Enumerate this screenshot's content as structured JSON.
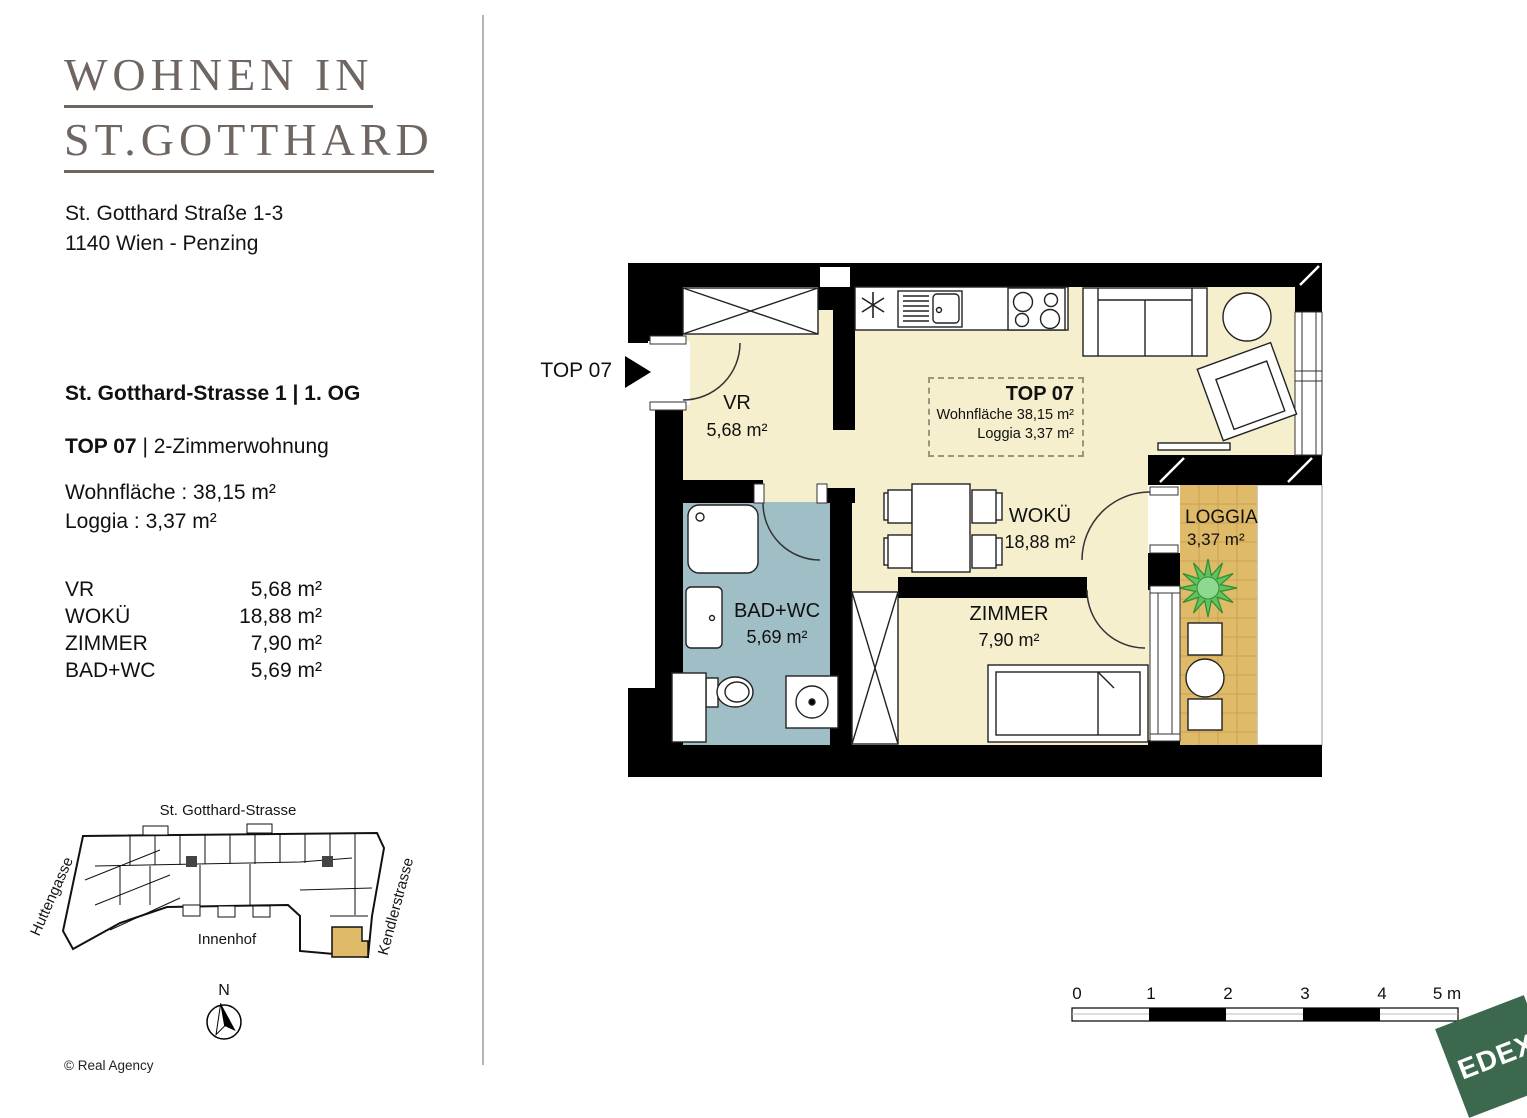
{
  "branding": {
    "title_line1": "WOHNEN IN",
    "title_line2": "ST.GOTTHARD",
    "address_line1": "St. Gotthard Straße 1-3",
    "address_line2": "1140 Wien - Penzing"
  },
  "unit_info": {
    "location": "St. Gotthard-Strasse 1 | 1. OG",
    "unit_name": "TOP 07",
    "unit_type": "| 2-Zimmerwohnung",
    "living_area": "Wohnfläche : 38,15 m²",
    "loggia_area": "Loggia : 3,37 m²"
  },
  "room_table": [
    {
      "name": "VR",
      "area": "5,68 m²"
    },
    {
      "name": "WOKÜ",
      "area": "18,88 m²"
    },
    {
      "name": "ZIMMER",
      "area": "7,90 m²"
    },
    {
      "name": "BAD+WC",
      "area": "5,69 m²"
    }
  ],
  "floor_plan": {
    "entry_label": "TOP 07",
    "info_box": {
      "title": "TOP 07",
      "living": "Wohnfläche 38,15 m²",
      "loggia": "Loggia 3,37 m²"
    },
    "rooms": {
      "vr": {
        "name": "VR",
        "area": "5,68 m²"
      },
      "woku": {
        "name": "WOKÜ",
        "area": "18,88 m²"
      },
      "zimmer": {
        "name": "ZIMMER",
        "area": "7,90 m²"
      },
      "bad": {
        "name": "BAD+WC",
        "area": "5,69 m²"
      },
      "loggia": {
        "name": "LOGGIA",
        "area": "3,37 m²"
      }
    }
  },
  "site_plan": {
    "street_top": "St. Gotthard-Strasse",
    "street_left": "Huttengasse",
    "street_right": "Kendlerstrasse",
    "courtyard": "Innenhof",
    "north": "N"
  },
  "scale_bar": {
    "labels": [
      "0",
      "1",
      "2",
      "3",
      "4",
      "5 m"
    ]
  },
  "logo_text": "EDEX",
  "copyright": "© Real Agency",
  "colors": {
    "floor_cream": "#f5efcd",
    "bath_blue": "#a0bec5",
    "loggia_tan": "#dfba68",
    "wall_black": "#000000",
    "title_gray": "#6f6661",
    "logo_green": "#3c684e"
  }
}
